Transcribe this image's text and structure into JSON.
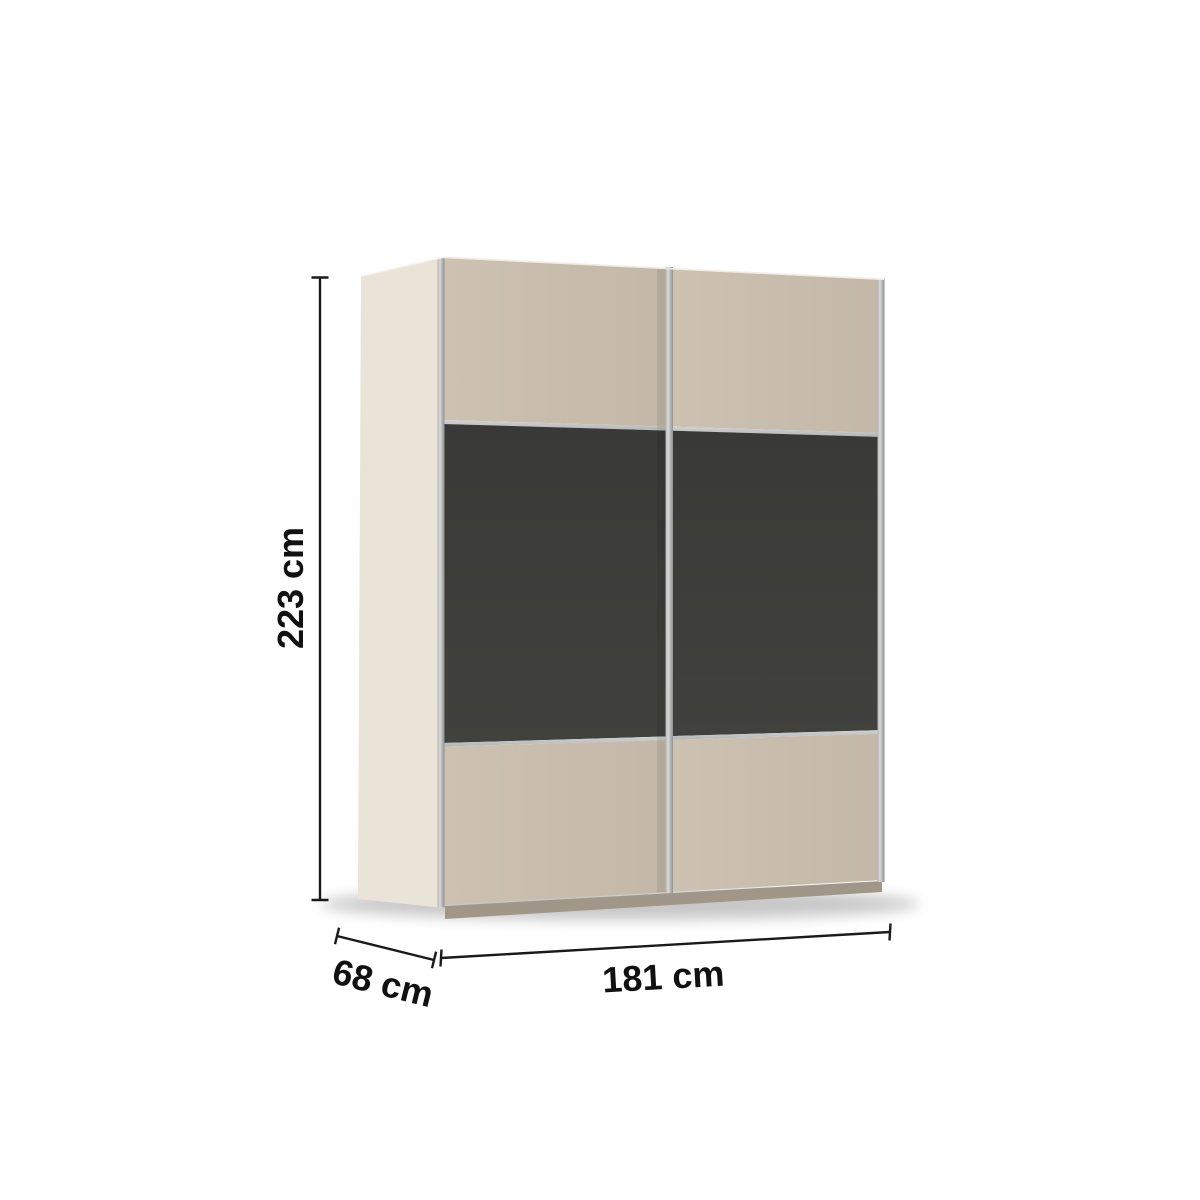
{
  "dimensions": {
    "height_label": "223 cm",
    "depth_label": "68 cm",
    "width_label": "181 cm"
  },
  "colors": {
    "background": "#ffffff",
    "side_panel": "#eae3d7",
    "door_beige_light": "#cdc2b2",
    "door_beige_dark": "#c3b8a7",
    "panel_dark": "#393937",
    "panel_dark_soft": "#41413e",
    "aluminum_light": "#d9dad9",
    "aluminum_mid": "#b0b2b1",
    "aluminum_dark": "#8d908f",
    "trim_horizontal_light": "#cfd2d1",
    "trim_horizontal_dark": "#b3b6b5",
    "plinth": "#a09788",
    "floor_shadow": "#000000",
    "dimension_line": "#1a1a1a",
    "label_text": "#111111"
  }
}
